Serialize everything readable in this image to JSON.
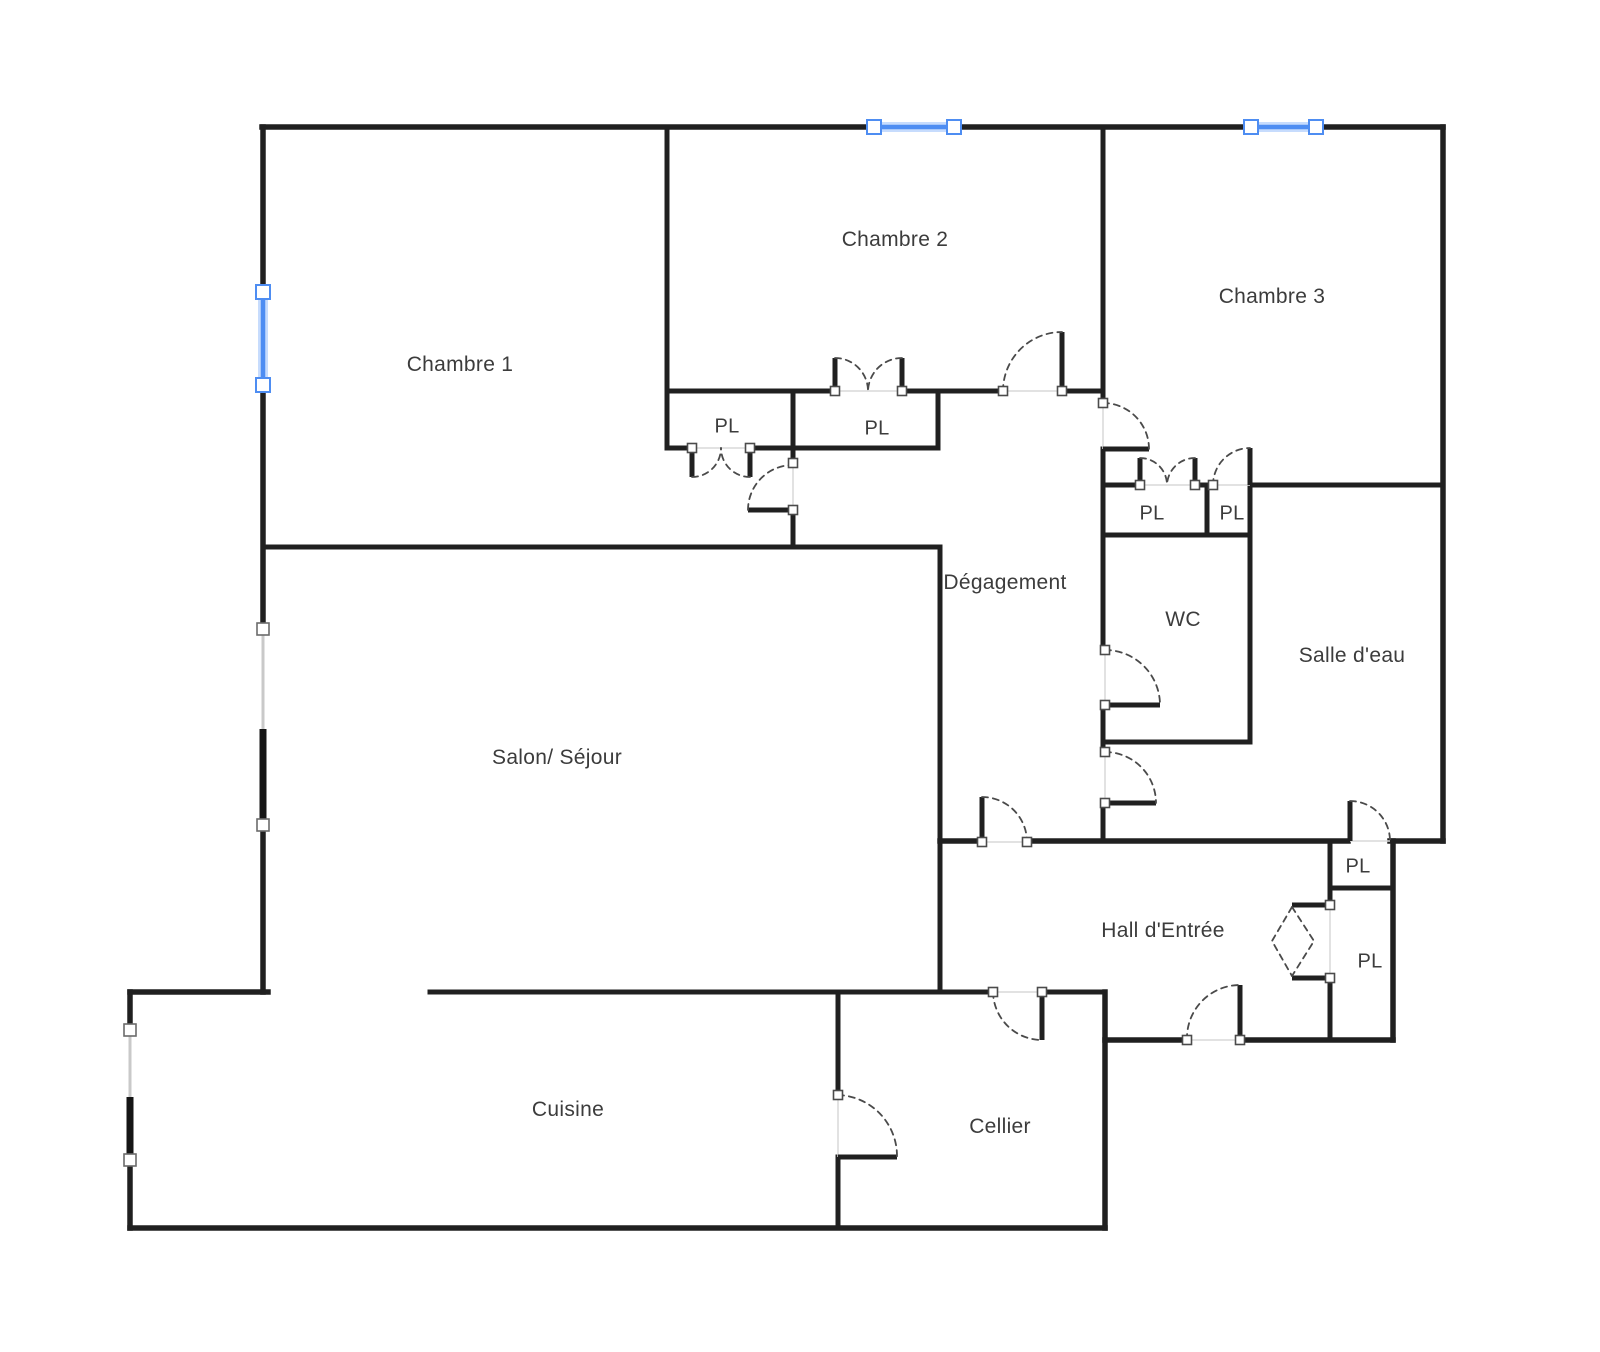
{
  "title": "Plan d'appartement",
  "colors": {
    "wall_color": "#202020",
    "arc_color": "#4a4a4a",
    "label_color": "#3c3c3c",
    "selected_color": "#4e8df2",
    "selected_glow": "#c7dcfd",
    "window_color": "#c9c9c9",
    "handle_border": "#4b4b4b",
    "background": "#ffffff"
  },
  "rooms": [
    {
      "id": "chambre-1",
      "label": "Chambre 1"
    },
    {
      "id": "chambre-2",
      "label": "Chambre 2"
    },
    {
      "id": "chambre-3",
      "label": "Chambre 3"
    },
    {
      "id": "salon-sejour",
      "label": "Salon/ Séjour"
    },
    {
      "id": "degagement",
      "label": "Dégagement"
    },
    {
      "id": "wc",
      "label": "WC"
    },
    {
      "id": "salle-deau",
      "label": "Salle d'eau"
    },
    {
      "id": "hall-entree",
      "label": "Hall d'Entrée"
    },
    {
      "id": "cuisine",
      "label": "Cuisine"
    },
    {
      "id": "cellier",
      "label": "Cellier"
    }
  ],
  "closets": [
    {
      "label": "PL"
    },
    {
      "label": "PL"
    },
    {
      "label": "PL"
    },
    {
      "label": "PL"
    },
    {
      "label": "PL"
    },
    {
      "label": "PL"
    }
  ],
  "windows": [
    {
      "location": "top-wall-chambre-2",
      "state": "selected"
    },
    {
      "location": "top-wall-chambre-3",
      "state": "selected"
    },
    {
      "location": "left-wall-chambre-1",
      "state": "selected"
    },
    {
      "location": "left-wall-salon",
      "state": "unselected"
    },
    {
      "location": "left-wall-cuisine",
      "state": "unselected"
    }
  ]
}
